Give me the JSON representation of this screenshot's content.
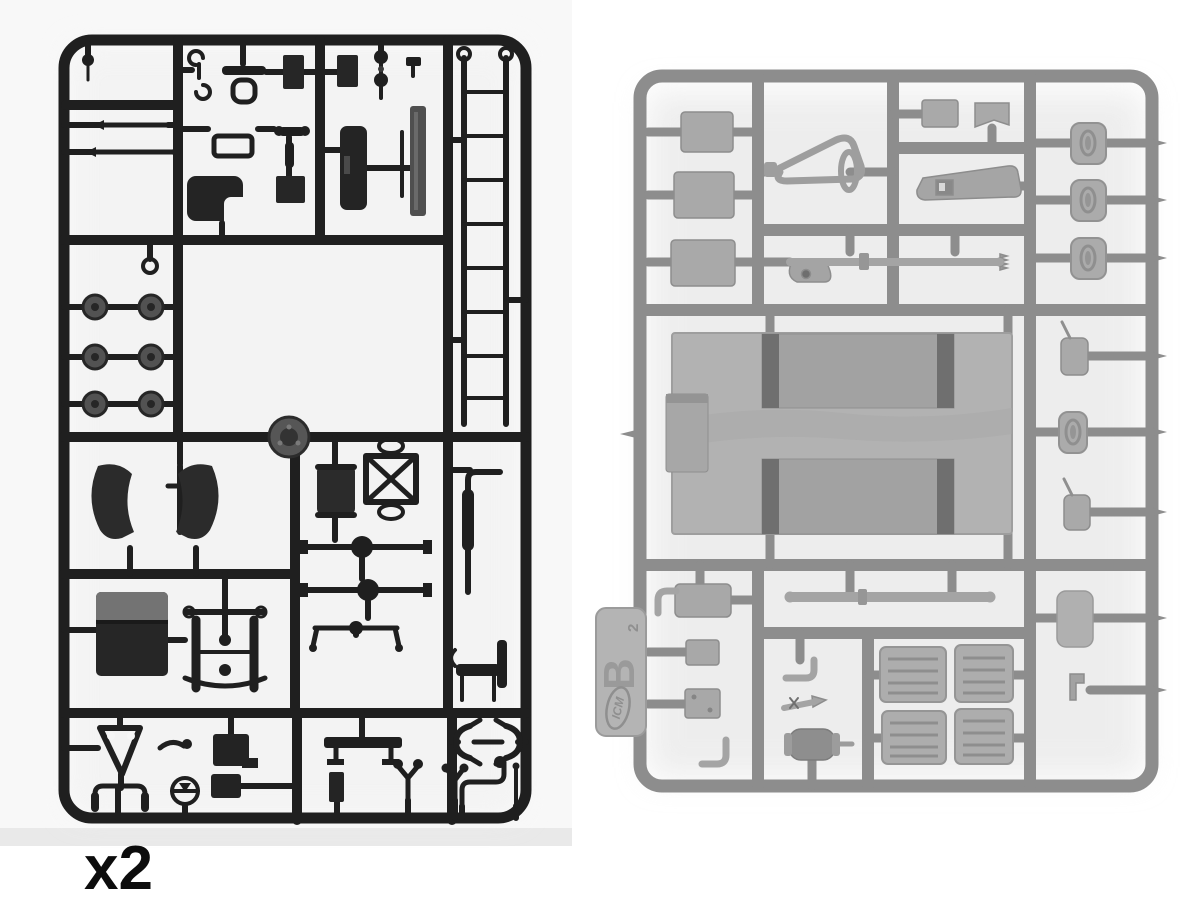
{
  "image": {
    "description": "Photograph of two injection-molded plastic model kit sprues (part frames)",
    "background_color": "#ffffff"
  },
  "left_sprue": {
    "label": "dark styrene sprue",
    "quantity_label": "x2",
    "plastic_color": "#1f1f1f",
    "photo_background": "#f8f8f8",
    "parts_visible": [
      "hook",
      "tie rods",
      "road wheels",
      "bucket seats",
      "instrument box",
      "ladder chassis frame",
      "fenders",
      "radiator",
      "axles with differential",
      "leaf spring suspension",
      "cab body",
      "tow hitch A-frame",
      "steering wheel",
      "handlebars",
      "exhaust pipe",
      "bench",
      "small levers and forks"
    ]
  },
  "right_sprue": {
    "label": "gray styrene sprue",
    "plastic_color": "#8d8d8d",
    "parts_color": "#a9a9a9",
    "photo_background": "#ffffff",
    "tab": {
      "letter": "B",
      "mold_number": "2",
      "brand": "ICM"
    },
    "parts_visible": [
      "flat hatch panels",
      "tow triangle",
      "threaded rod",
      "wedge bracket",
      "oval hatch covers",
      "cargo bed floor with two benches",
      "tool box",
      "mirrors",
      "muffler",
      "exhaust pipes",
      "slatted crate panels",
      "long pipe"
    ]
  }
}
